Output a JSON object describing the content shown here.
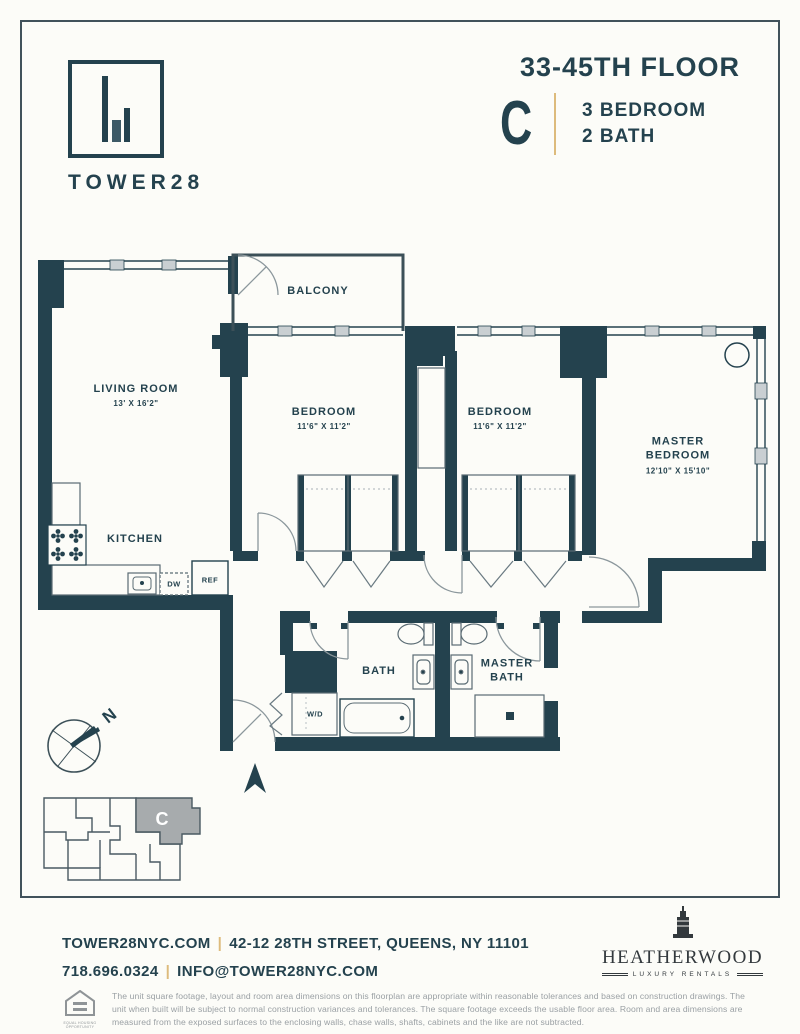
{
  "header": {
    "logo_text": "TOWER28",
    "floor": "33-45TH FLOOR",
    "unit": "C",
    "bed": "3 BEDROOM",
    "bath": "2 BATH"
  },
  "plan": {
    "rooms": {
      "balcony": {
        "name": "BALCONY"
      },
      "living_room": {
        "name": "LIVING ROOM",
        "dims": "13' X 16'2\""
      },
      "kitchen": {
        "name": "KITCHEN"
      },
      "bedroom_1": {
        "name": "BEDROOM",
        "dims": "11'6\" X 11'2\""
      },
      "bedroom_2": {
        "name": "BEDROOM",
        "dims": "11'6\" X 11'2\""
      },
      "master_bedroom": {
        "name": "MASTER BEDROOM",
        "dims": "12'10\" X 15'10\""
      },
      "bath": {
        "name": "BATH"
      },
      "master_bath": {
        "name": "MASTER BATH"
      }
    },
    "fixtures": {
      "washer_dryer": "W/D",
      "dishwasher": "DW",
      "refrigerator": "REF"
    },
    "compass_label": "N",
    "keyplan_unit": "C"
  },
  "colors": {
    "wall": "#24424e",
    "gold": "#ddbb7c",
    "keyplan_unit_fill": "#a7abad"
  },
  "footer": {
    "website": "TOWER28NYC.COM",
    "separator": "|",
    "address": "42-12 28TH STREET, QUEENS, NY 11101",
    "phone": "718.696.0324",
    "email": "INFO@TOWER28NYC.COM",
    "brand_name": "HEATHERWOOD",
    "brand_tagline": "LUXURY RENTALS",
    "equal_housing": "EQUAL HOUSING OPPORTUNITY",
    "disclaimer": "The unit square footage, layout and room area dimensions on this floorplan are appropriate within reasonable tolerances and based on construction drawings. The unit when built will be subject to normal construction variances and tolerances. The square footage exceeds the usable floor area. Room and area dimensions are measured from the exposed surfaces to the enclosing walls, chase walls, shafts, cabinets and the like are not subtracted."
  }
}
